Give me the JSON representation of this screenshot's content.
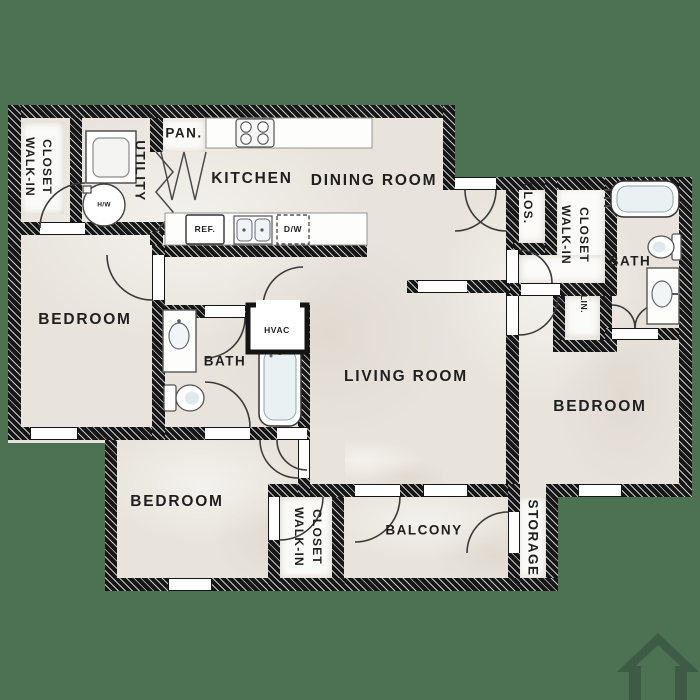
{
  "colors": {
    "background": "#4d7153",
    "floor": "#e8e4dd",
    "wall": "#161616",
    "house_icon": "#3d5b45"
  },
  "rooms": {
    "walk_in_closet_top_left": {
      "line1": "WALK-IN",
      "line2": "CLOSET"
    },
    "utility": {
      "label": "UTILITY"
    },
    "pantry": {
      "label": "PAN."
    },
    "kitchen": {
      "label": "KITCHEN"
    },
    "dining_room": {
      "label": "DINING ROOM"
    },
    "closet_small": {
      "label": "CLOS."
    },
    "walk_in_closet_top_right": {
      "line1": "WALK-IN",
      "line2": "CLOSET"
    },
    "bath_top_right": {
      "label": "BATH"
    },
    "linen": {
      "label": "LIN."
    },
    "bedroom_left": {
      "label": "BEDROOM"
    },
    "bath_middle": {
      "label": "BATH"
    },
    "hvac": {
      "label": "HVAC"
    },
    "living_room": {
      "label": "LIVING ROOM"
    },
    "bedroom_right": {
      "label": "BEDROOM"
    },
    "bedroom_bottom": {
      "label": "BEDROOM"
    },
    "walk_in_closet_bottom": {
      "line1": "WALK-IN",
      "line2": "CLOSET"
    },
    "balcony": {
      "label": "BALCONY"
    },
    "storage": {
      "label": "STORAGE"
    }
  },
  "fixtures": {
    "water_heater": "H/W",
    "refrigerator": "REF.",
    "dishwasher": "D/W"
  }
}
